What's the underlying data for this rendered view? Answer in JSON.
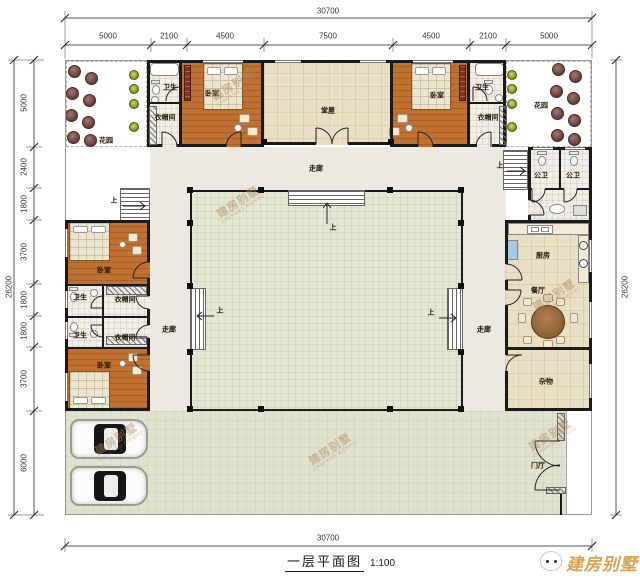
{
  "dimensions": {
    "top_total": "30700",
    "bottom_total": "30700",
    "left_total": "26200",
    "right_total": "26200",
    "top_segments": [
      "5000",
      "2100",
      "4500",
      "7500",
      "4500",
      "2100",
      "5000"
    ],
    "left_segments": [
      "5000",
      "2400",
      "1800",
      "3700",
      "1800",
      "1800",
      "3700",
      "6000"
    ]
  },
  "rooms": {
    "garden": "花园",
    "bathroom": "卫生",
    "cloakroom": "衣帽间",
    "bedroom": "卧室",
    "hall": "堂屋",
    "corridor": "走廊",
    "toilet": "公卫",
    "kitchen": "厨房",
    "dining": "餐厅",
    "storage": "杂物",
    "gate": "门厅",
    "up": "上"
  },
  "title": {
    "text": "一层平面图",
    "scale": "1:100"
  },
  "brand": {
    "name": "建房别墅"
  },
  "watermark": {
    "cn": "建房别墅",
    "en": "JIANFANG BIESHU"
  }
}
